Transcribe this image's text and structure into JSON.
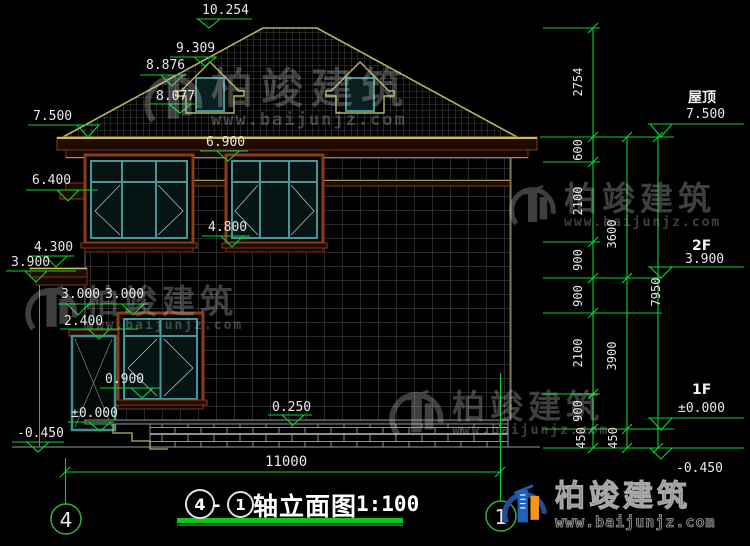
{
  "watermark": {
    "company": "柏竣建筑",
    "website": "www.baijunjz.com"
  },
  "title": {
    "axis_from": "4",
    "separator": "-",
    "axis_to": "1",
    "text": "轴立面图",
    "scale": "1:100"
  },
  "axes": {
    "left_bubble": "4",
    "right_bubble": "1",
    "span": "11000"
  },
  "levels": {
    "left": [
      "10.254",
      "9.309",
      "8.876",
      "8.077",
      "7.500",
      "6.900",
      "6.400",
      "4.800",
      "4.300",
      "3.900",
      "3.000",
      "3.000",
      "2.400",
      "0.900",
      "±0.000",
      "0.250",
      "-0.450"
    ],
    "right": [
      {
        "label": "屋顶",
        "value": "7.500"
      },
      {
        "label": "2F",
        "value": "3.900"
      },
      {
        "label": "1F",
        "value": "±0.000"
      },
      {
        "label": "",
        "value": "-0.450"
      }
    ]
  },
  "chains": {
    "a": [
      "2754",
      "600",
      "2100",
      "900",
      "900",
      "2100",
      "900",
      "450"
    ],
    "b": [
      "3600",
      "3900",
      "450"
    ],
    "c": [
      "7950"
    ]
  },
  "colors": {
    "cad_green": "#0ad42e",
    "roof_outline": "#b6b661",
    "trim_brown": "#8a3b18",
    "frame_teal": "#4a9595",
    "brand_blue": "#1d4f9e",
    "brand_orange": "#f2951f"
  }
}
